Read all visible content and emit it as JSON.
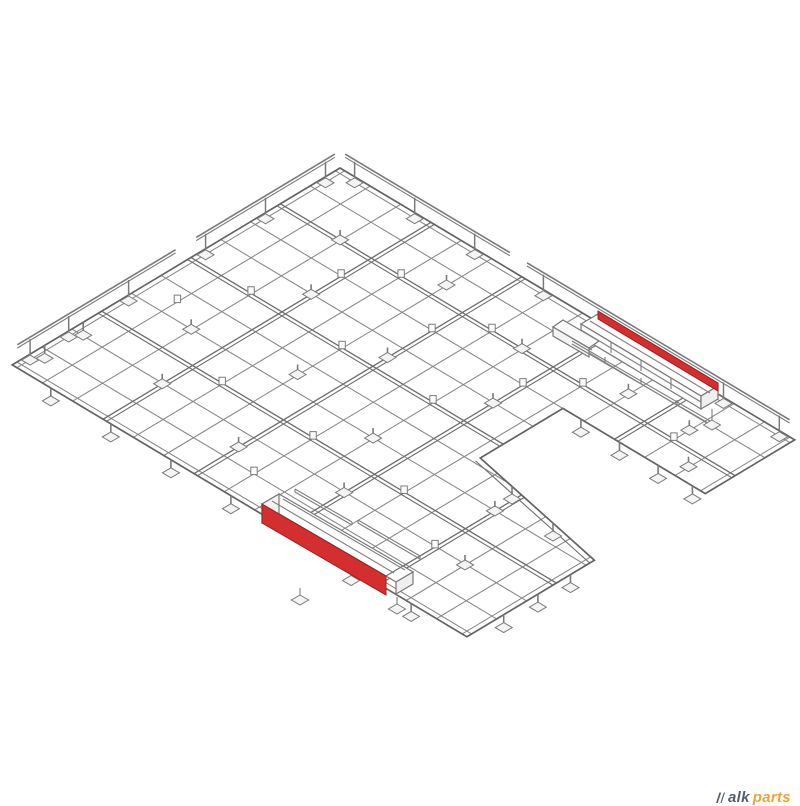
{
  "canvas": {
    "width": 800,
    "height": 800,
    "background": "#ffffff"
  },
  "colors": {
    "line": "#878787",
    "beam": "#6e6e6e",
    "edge": "#636363",
    "rail": "#7a7a7a",
    "foot_fill": "#f4f4f4",
    "foot_stroke": "#7a7a7a",
    "red": "#d32f2f",
    "red_edge": "#9a1d1d",
    "watermark_dark": "#55606e",
    "watermark_accent": "#f0a235"
  },
  "drawing": {
    "type": "isometric-wireframe",
    "iso": {
      "origin": [
        340,
        168
      ],
      "e1": [
        0.858,
        0.513
      ],
      "e2": [
        -0.856,
        0.514
      ],
      "u_max": 530,
      "v_max": 383
    },
    "outline_uv": [
      [
        0,
        0
      ],
      [
        530,
        0
      ],
      [
        530,
        104.5
      ],
      [
        364,
        104.5
      ],
      [
        364,
        201
      ],
      [
        530,
        234
      ],
      [
        530,
        383
      ],
      [
        0,
        383
      ]
    ],
    "grid": {
      "u_lines": [
        0,
        5.5,
        35.3,
        70.7,
        106,
        141.3,
        176.7,
        212,
        247.3,
        282.7,
        318,
        353.3,
        388.7,
        424,
        459.3,
        494.7,
        524.5,
        530
      ],
      "v_lines": [
        0,
        5.5,
        34.8,
        69.6,
        104.5,
        139.3,
        174.1,
        208.9,
        243.7,
        278.5,
        313.3,
        348.2,
        377.5,
        383
      ],
      "u_beams": [
        106,
        212,
        318,
        424
      ],
      "v_beams": [
        69.6,
        174.1,
        278.5
      ],
      "diagonal_inner_uv": [
        [
          364,
          206.5
        ],
        [
          530,
          239.5
        ]
      ]
    },
    "clips_uv": [
      [
        141,
        70
      ],
      [
        247,
        70
      ],
      [
        353,
        70
      ],
      [
        459,
        70
      ],
      [
        70,
        174
      ],
      [
        176,
        174
      ],
      [
        282,
        174
      ],
      [
        106,
        105
      ],
      [
        212,
        105
      ],
      [
        318,
        105
      ],
      [
        141,
        279
      ],
      [
        247,
        279
      ],
      [
        353,
        279
      ],
      [
        424,
        314
      ],
      [
        35,
        225
      ],
      [
        247,
        348
      ]
    ],
    "feet_top_uv": [
      [
        70,
        70
      ],
      [
        176,
        52
      ],
      [
        282,
        70
      ],
      [
        388,
        52
      ],
      [
        459,
        52
      ],
      [
        494,
        88
      ],
      [
        106,
        140
      ],
      [
        212,
        157
      ],
      [
        318,
        140
      ],
      [
        70,
        244
      ],
      [
        176,
        226
      ],
      [
        282,
        244
      ],
      [
        106,
        314
      ],
      [
        212,
        331
      ],
      [
        318,
        314
      ],
      [
        424,
        244
      ],
      [
        459,
        314
      ]
    ],
    "feet_under_uv": [
      [
        45,
        383
      ],
      [
        115,
        383
      ],
      [
        185,
        383
      ],
      [
        255,
        383
      ],
      [
        395,
        383
      ],
      [
        465,
        383
      ],
      [
        530,
        262
      ],
      [
        530,
        300
      ],
      [
        530,
        340
      ],
      [
        385,
        104.5
      ],
      [
        430,
        104.5
      ],
      [
        475,
        104.5
      ],
      [
        515,
        104.5
      ],
      [
        0,
        300
      ],
      [
        0,
        345
      ]
    ],
    "feet_under_xy": [
      [
        512,
        486
      ],
      [
        553,
        523
      ]
    ],
    "guardrails": {
      "top_right": {
        "segments": [
          [
            6,
            198
          ],
          [
            218,
            524
          ]
        ],
        "posts": [
          20,
          90,
          160,
          240,
          450,
          515
        ],
        "lift": 17
      },
      "top_left": {
        "segments": [
          [
            6,
            168
          ],
          [
            192,
            377
          ]
        ],
        "posts": [
          20,
          90,
          160,
          250,
          320,
          365
        ],
        "lift": 17
      }
    },
    "assemblies": [
      {
        "name": "rail-assembly-upper",
        "polys": [
          {
            "pts": [
              [
                598,
                314
              ],
              [
                718,
                386
              ],
              [
                701,
                396
              ],
              [
                581,
                324
              ]
            ],
            "fill": "#ffffff"
          },
          {
            "pts": [
              [
                581,
                324
              ],
              [
                701,
                396
              ],
              [
                701,
                409
              ],
              [
                581,
                337
              ]
            ],
            "fill": "#fcfcfc"
          },
          {
            "pts": [
              [
                718,
                386
              ],
              [
                718,
                399
              ],
              [
                701,
                409
              ],
              [
                701,
                396
              ]
            ],
            "fill": "#efefef"
          },
          {
            "pts": [
              [
                563,
                320
              ],
              [
                599,
                341
              ],
              [
                589,
                348
              ],
              [
                553,
                327
              ]
            ],
            "fill": "#fafafa"
          },
          {
            "pts": [
              [
                553,
                327
              ],
              [
                589,
                348
              ],
              [
                589,
                357
              ],
              [
                553,
                336
              ]
            ],
            "fill": "#f3f3f3"
          }
        ],
        "red": {
          "pts": [
            [
              598,
              311
            ],
            [
              718,
              383
            ],
            [
              718,
              391
            ],
            [
              598,
              319
            ]
          ]
        },
        "lines": [
          [
            590,
            321,
            710,
            393
          ],
          [
            581,
            330,
            701,
            402
          ],
          [
            611,
            342,
            611,
            353
          ],
          [
            641,
            360,
            641,
            371
          ],
          [
            671,
            378,
            671,
            389
          ],
          [
            572,
            341,
            710,
            421
          ],
          [
            572,
            344,
            710,
            424
          ],
          [
            605,
            357,
            605,
            363
          ],
          [
            641,
            378,
            641,
            384
          ],
          [
            677,
            400,
            677,
            406
          ],
          [
            560,
            331,
            592,
            350
          ],
          [
            712,
            409,
            712,
            421
          ]
        ],
        "feet": [
          [
            712,
            425
          ]
        ]
      },
      {
        "name": "rail-assembly-lower",
        "polys": [
          {
            "pts": [
              [
                279,
                494
              ],
              [
                403,
                566
              ],
              [
                386,
                576
              ],
              [
                262,
                504
              ]
            ],
            "fill": "#ffffff"
          },
          {
            "pts": [
              [
                262,
                504
              ],
              [
                279,
                494
              ],
              [
                279,
                514
              ],
              [
                262,
                523
              ]
            ],
            "fill": "#f2f2f2"
          },
          {
            "pts": [
              [
                386,
                576
              ],
              [
                403,
                566
              ],
              [
                413,
                572
              ],
              [
                396,
                582
              ]
            ],
            "fill": "#ffffff"
          },
          {
            "pts": [
              [
                396,
                582
              ],
              [
                413,
                572
              ],
              [
                413,
                584
              ],
              [
                396,
                594
              ]
            ],
            "fill": "#efefef"
          }
        ],
        "red": {
          "pts": [
            [
              262,
              504
            ],
            [
              386,
              576
            ],
            [
              386,
              595
            ],
            [
              262,
              523
            ]
          ]
        },
        "lines": [
          [
            283,
            499,
            405,
            570
          ],
          [
            272,
            501,
            394,
            573
          ],
          [
            295,
            489,
            352,
            522
          ],
          [
            295,
            492,
            352,
            525
          ],
          [
            295,
            489,
            295,
            492
          ],
          [
            352,
            522,
            352,
            525
          ],
          [
            358,
            520,
            420,
            556
          ],
          [
            358,
            523,
            420,
            559
          ],
          [
            358,
            520,
            358,
            523
          ],
          [
            420,
            556,
            420,
            559
          ],
          [
            300,
            588,
            300,
            597
          ],
          [
            397,
            597,
            397,
            606
          ]
        ],
        "feet": [
          [
            300,
            600
          ],
          [
            397,
            609
          ]
        ]
      }
    ]
  },
  "watermark": {
    "text_dark": "alk",
    "text_accent": "parts"
  }
}
